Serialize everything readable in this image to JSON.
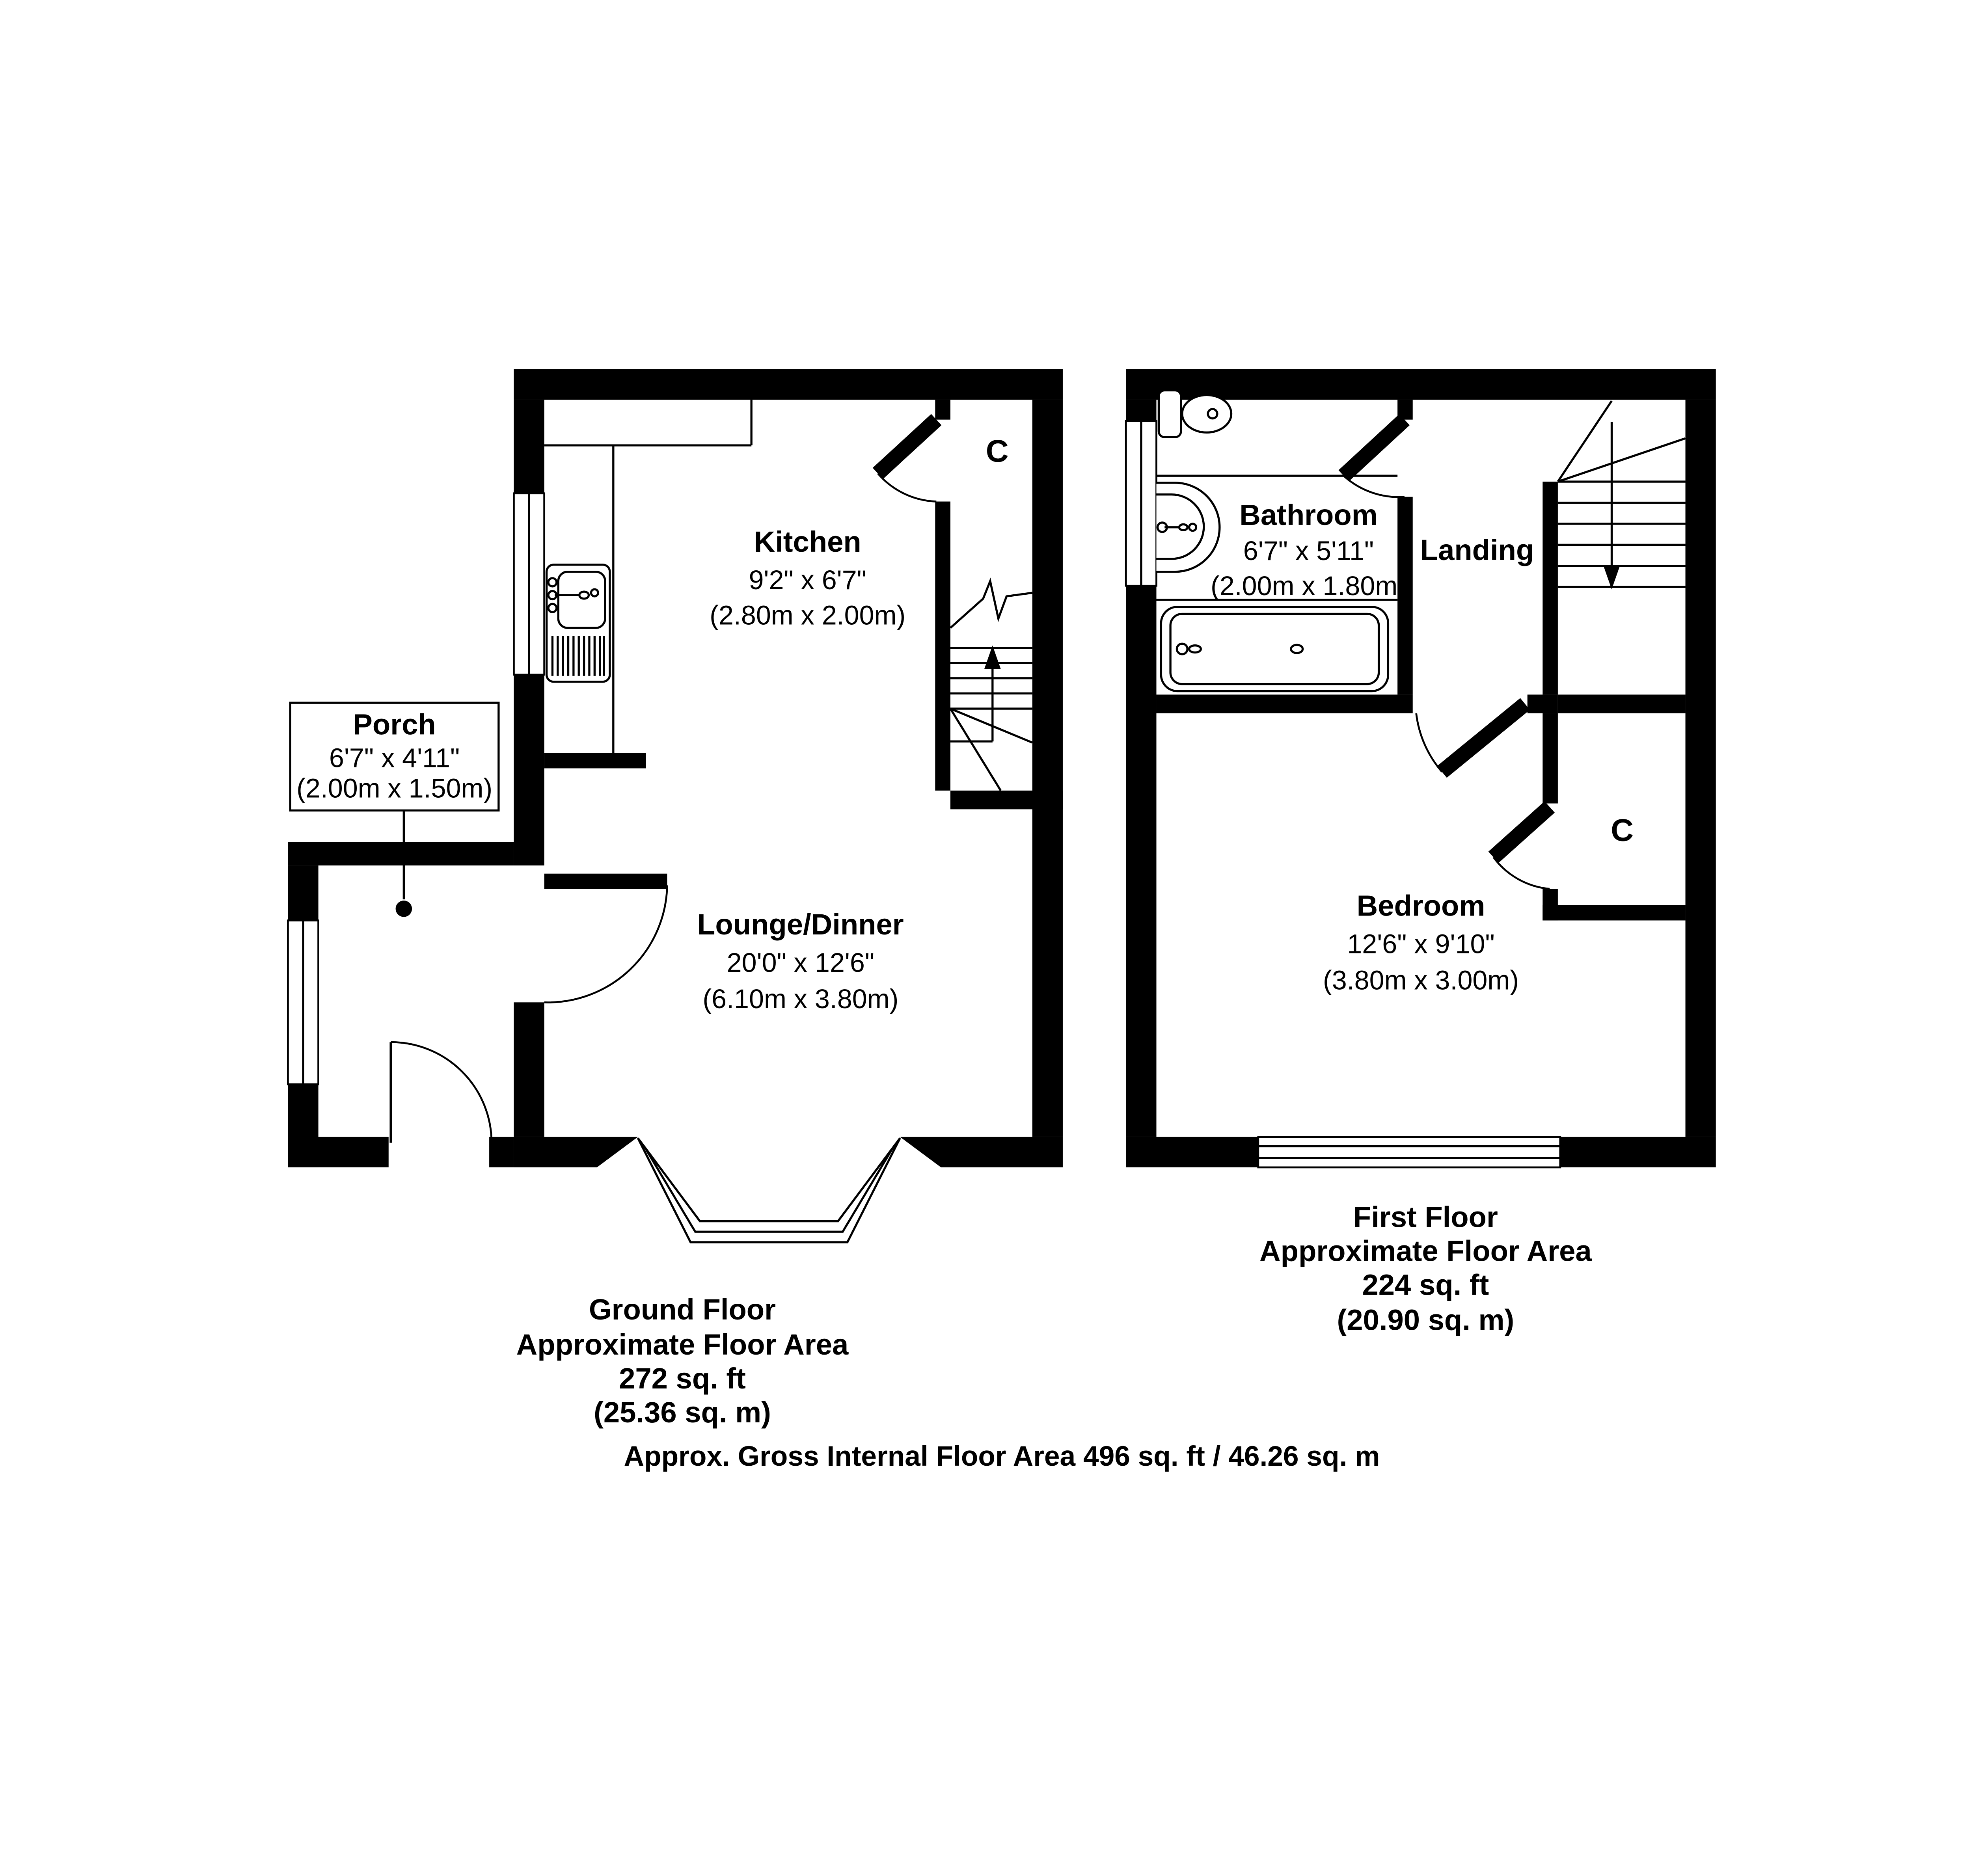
{
  "meta": {
    "wall_color": "#000000",
    "background_color": "#ffffff"
  },
  "ground_floor": {
    "caption": [
      "Ground Floor",
      "Approximate Floor Area",
      "272 sq. ft",
      "(25.36 sq. m)"
    ],
    "rooms": {
      "kitchen": {
        "name": "Kitchen",
        "dims_imperial": "9'2\" x 6'7\"",
        "dims_metric": "(2.80m x 2.00m)"
      },
      "lounge": {
        "name": "Lounge/Dinner",
        "dims_imperial": "20'0\" x 12'6\"",
        "dims_metric": "(6.10m x 3.80m)"
      },
      "porch": {
        "name": "Porch",
        "dims_imperial": "6'7\" x 4'11\"",
        "dims_metric": "(2.00m x 1.50m)"
      },
      "closet": {
        "label": "C"
      }
    }
  },
  "first_floor": {
    "caption": [
      "First Floor",
      "Approximate Floor Area",
      "224 sq. ft",
      "(20.90 sq. m)"
    ],
    "rooms": {
      "bathroom": {
        "name": "Bathroom",
        "dims_imperial": "6'7\" x 5'11\"",
        "dims_metric": "(2.00m x 1.80m)"
      },
      "landing": {
        "name": "Landing"
      },
      "bedroom": {
        "name": "Bedroom",
        "dims_imperial": "12'6\" x 9'10\"",
        "dims_metric": "(3.80m x 3.00m)"
      },
      "closet": {
        "label": "C"
      }
    }
  },
  "footer": {
    "text": "Approx. Gross Internal Floor Area 496 sq. ft / 46.26 sq. m"
  }
}
